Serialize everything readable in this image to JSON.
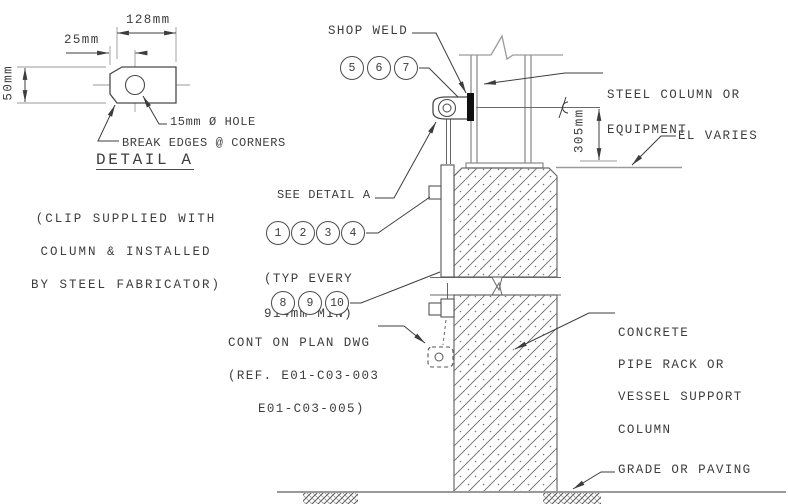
{
  "detail": {
    "dim_width": "128mm",
    "dim_hole_offset": "25mm",
    "dim_height": "50mm",
    "hole_label": "15mm Ø HOLE",
    "edge_note": "BREAK EDGES @ CORNERS",
    "title": "DETAIL A",
    "note": [
      "(CLIP SUPPLIED WITH",
      "COLUMN & INSTALLED",
      "BY STEEL FABRICATOR)"
    ]
  },
  "elevation": {
    "shop_weld_label": "SHOP WELD",
    "steel_column_label": [
      "STEEL COLUMN OR",
      "EQUIPMENT"
    ],
    "el_varies_label": "EL VARIES",
    "dim_offset": "305mm",
    "see_detail_label": "SEE DETAIL A",
    "typ_note": [
      "(TYP EVERY",
      "914mm MIN)"
    ],
    "cont_note": [
      "CONT ON PLAN DWG",
      "(REF. E01-C03-003",
      "E01-C03-005)"
    ],
    "concrete_label": [
      "CONCRETE",
      "PIPE RACK OR",
      "VESSEL SUPPORT",
      "COLUMN"
    ],
    "grade_label": "GRADE OR PAVING"
  },
  "callouts": {
    "weld_group": [
      "5",
      "6",
      "7"
    ],
    "clip_group": [
      "1",
      "2",
      "3",
      "4"
    ],
    "lower_group": [
      "8",
      "9",
      "10"
    ]
  },
  "colors": {
    "object_line": "#555555",
    "thin_line": "#999999",
    "text": "#3d3d3d",
    "weld_fill": "#111111",
    "background": "#ffffff"
  }
}
